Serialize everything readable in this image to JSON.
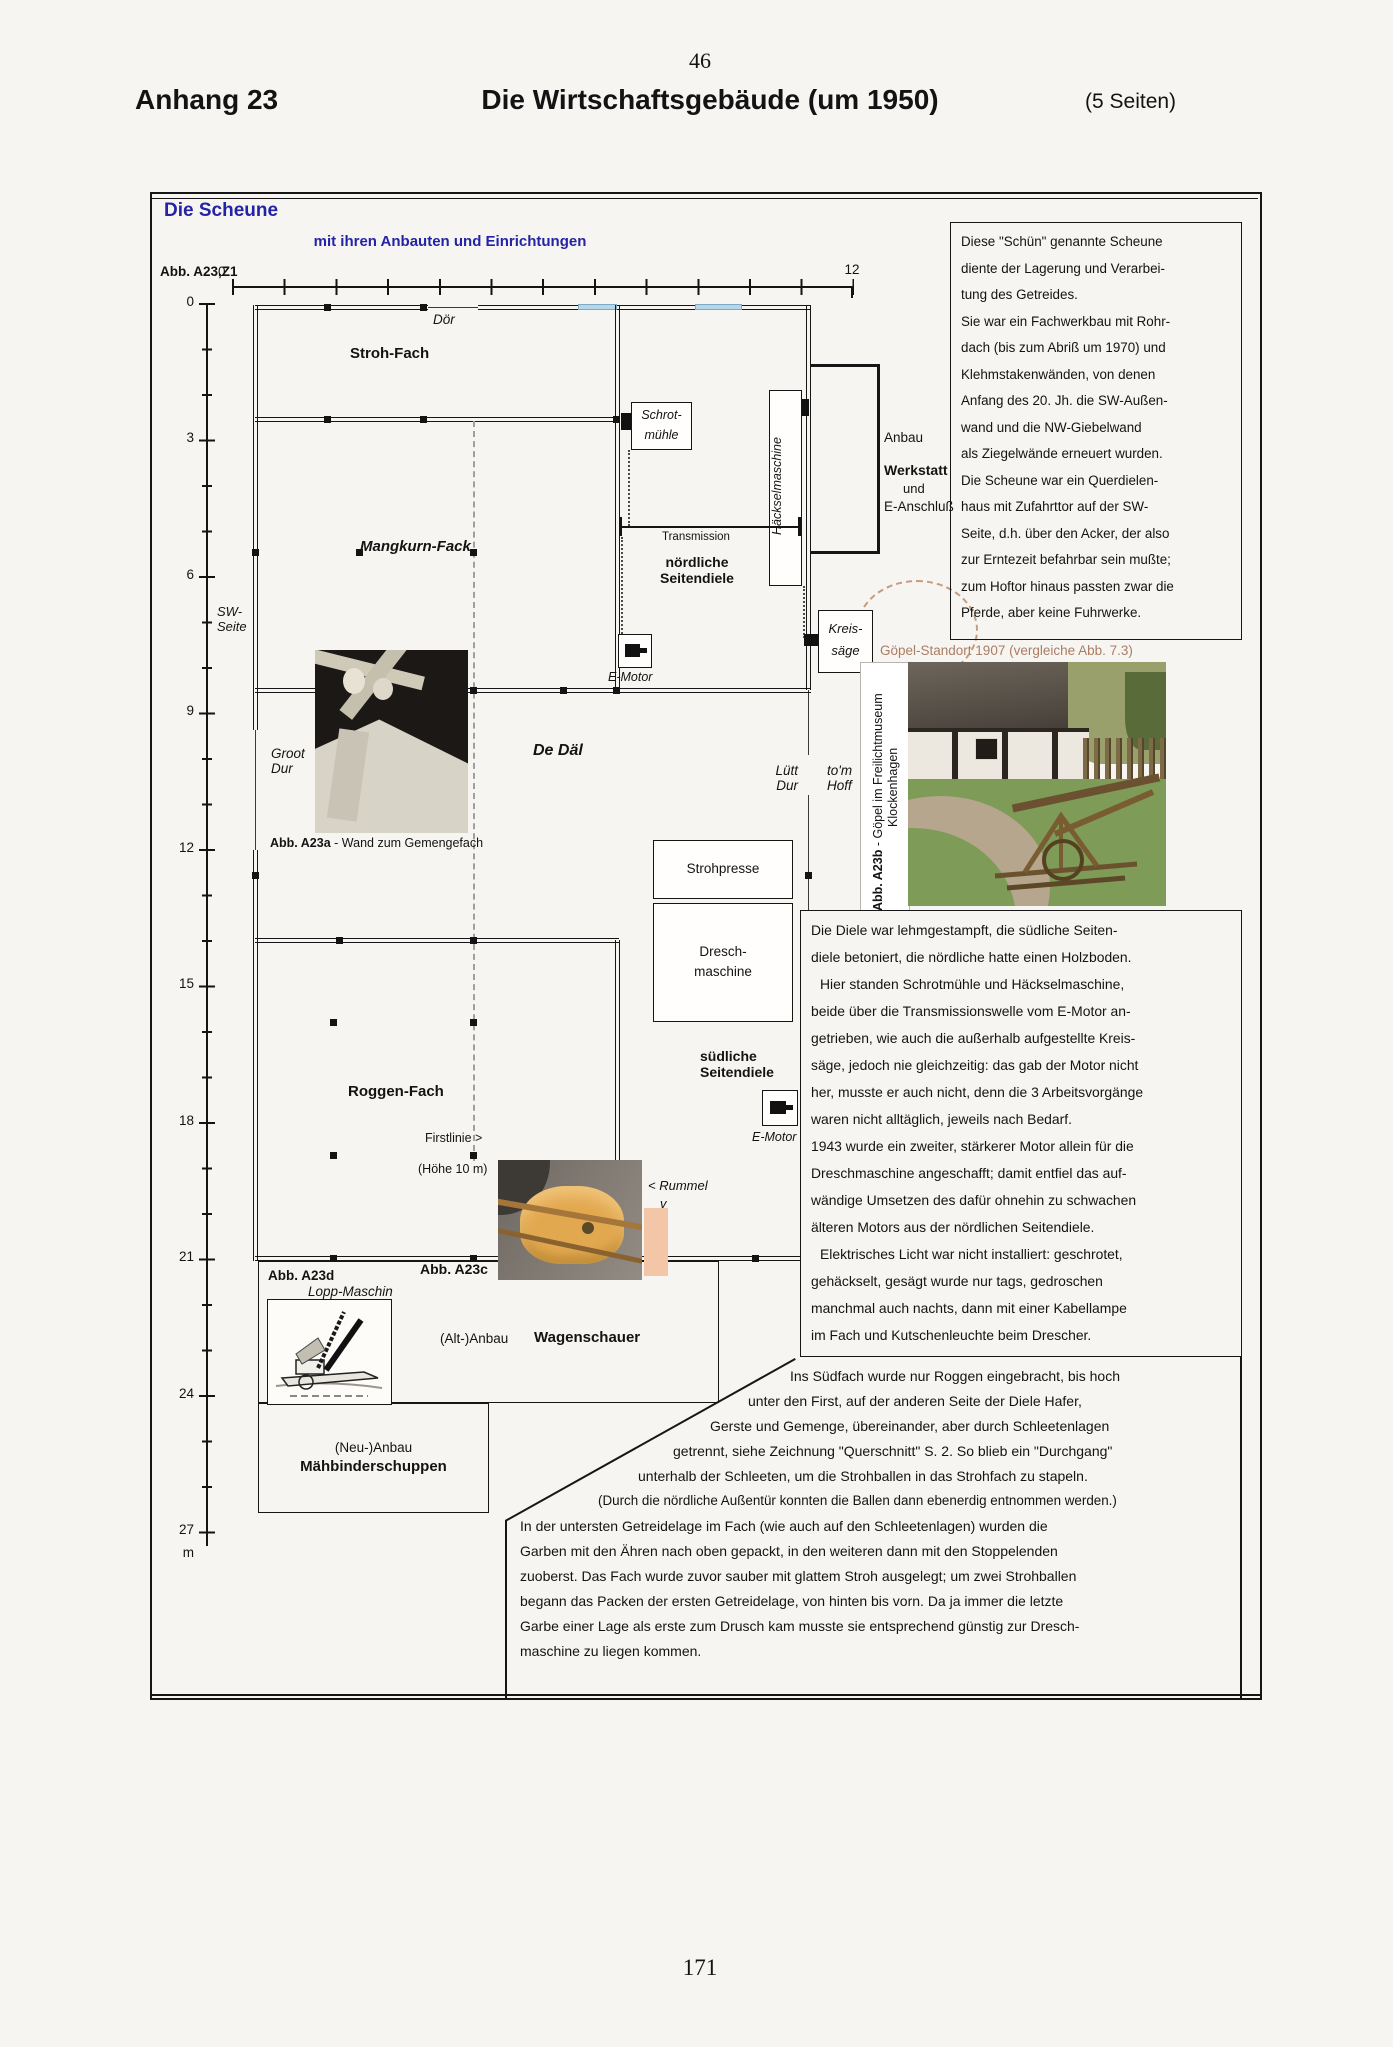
{
  "page": {
    "top_number": "46",
    "bottom_number": "171"
  },
  "header": {
    "left": "Anhang 23",
    "title": "Die Wirtschaftsgebäude (um 1950)",
    "right": "(5 Seiten)"
  },
  "box": {
    "title": "Die Scheune",
    "subtitle": "mit ihren Anbauten und Einrichtungen",
    "fig": "Abb. A23,Z1"
  },
  "ruler": {
    "h_start": "0",
    "h_end": "12",
    "v": [
      "0",
      "3",
      "6",
      "9",
      "12",
      "15",
      "18",
      "21",
      "24",
      "27"
    ],
    "unit": "m"
  },
  "plan": {
    "stroh_fach": "Stroh-Fach",
    "doer": "Dör",
    "schrot1": "Schrot-",
    "schrot2": "mühle",
    "haecksel": "Häckselmaschine",
    "anbau": "Anbau",
    "werkstatt": "Werkstatt",
    "und": "und",
    "e_anschluss": "E-Anschluß",
    "mangkurn": "Mangkurn-Fack",
    "transmission": "Transmission",
    "noerdliche1": "nördliche",
    "noerdliche2": "Seitendiele",
    "sw1": "SW-",
    "sw2": "Seite",
    "e_motor": "E-Motor",
    "kreis1": "Kreis-",
    "kreis2": "säge",
    "goepel": "Göpel-Standort 1907 (vergleiche Abb. 7.3)",
    "groot1": "Groot",
    "groot2": "Dur",
    "de_dael": "De Däl",
    "luett1": "Lütt",
    "luett2": "Dur",
    "hoff1": "to'm",
    "hoff2": "Hoff",
    "strohpresse": "Strohpresse",
    "dresch1": "Dresch-",
    "dresch2": "maschine",
    "suedliche1": "südliche",
    "suedliche2": "Seitendiele",
    "roggen": "Roggen-Fach",
    "firstlinie": "Firstlinie >",
    "hoehe": "(Höhe 10 m)",
    "rummel": "< Rummel",
    "rummel_v": "v"
  },
  "captions": {
    "a23a_b": "Abb. A23a",
    "a23a_t": " - Wand zum Gemengefach",
    "a23b_b": "Abb. A23b",
    "a23b_t": " - Göpel im Freilichtmuseum",
    "a23b_l2": "Klockenhagen",
    "a23c": "Abb. A23c",
    "a23d": "Abb. A23d",
    "a23d_t": "Lopp-Maschin",
    "alt_anbau": "(Alt-)Anbau",
    "wagenschauer": "Wagenschauer",
    "neu_anbau": "(Neu-)Anbau",
    "maehbinder": "Mähbinderschuppen"
  },
  "texts": {
    "right_top": [
      "Diese \"Schün\" genannte Scheune",
      "diente der Lagerung und Verarbei-",
      "tung des Getreides.",
      "Sie war ein Fachwerkbau mit Rohr-",
      "dach (bis zum Abriß um 1970) und",
      "Klehmstakenwänden, von denen",
      "Anfang des 20. Jh. die SW-Außen-",
      "wand und die NW-Giebelwand",
      "als Ziegelwände erneuert wurden.",
      "Die Scheune war ein Querdielen-",
      "haus mit Zufahrttor auf der SW-",
      "Seite, d.h. über den Acker, der also",
      "zur Erntezeit befahrbar sein mußte;",
      "zum Hoftor hinaus passten zwar die",
      "Pferde, aber keine Fuhrwerke."
    ],
    "right_mid": [
      "Die Diele war lehmgestampft, die südliche Seiten-",
      "diele betoniert, die nördliche hatte einen Holzboden.",
      "Hier standen Schrotmühle und Häckselmaschine,",
      "beide über die Transmissionswelle vom E-Motor an-",
      "getrieben, wie auch die außerhalb aufgestellte Kreis-",
      "säge, jedoch nie gleichzeitig: das gab der Motor nicht",
      "her, musste er auch nicht, denn die 3 Arbeitsvorgänge",
      "waren nicht alltäglich, jeweils nach Bedarf.",
      "1943 wurde ein zweiter, stärkerer Motor allein für die",
      "Dreschmaschine angeschafft; damit entfiel das auf-",
      "wändige Umsetzen des dafür ohnehin zu schwachen",
      "älteren Motors aus der nördlichen Seitendiele.",
      "Elektrisches Licht war nicht installiert: geschrotet,",
      "gehäckselt, gesägt wurde nur tags, gedroschen",
      "manchmal auch nachts, dann mit einer Kabellampe",
      "im Fach und Kutschenleuchte beim Drescher."
    ],
    "bottom": [
      "Ins Südfach wurde nur Roggen eingebracht, bis hoch",
      "unter den First, auf der anderen Seite der Diele Hafer,",
      "Gerste und Gemenge, übereinander, aber durch Schleetenlagen",
      "getrennt, siehe Zeichnung \"Querschnitt\" S. 2.  So blieb ein \"Durchgang\"",
      "unterhalb der Schleeten, um die Strohballen in das Strohfach zu stapeln.",
      "(Durch die nördliche Außentür konnten die Ballen dann ebenerdig entnommen werden.)",
      "In der untersten Getreidelage im Fach (wie auch auf den Schleetenlagen) wurden die",
      "Garben mit den Ähren nach oben gepackt, in den weiteren dann mit den Stoppelenden",
      "zuoberst. Das Fach wurde zuvor sauber mit glattem Stroh ausgelegt; um zwei Strohballen",
      "begann das Packen der ersten Getreidelage,  von hinten bis vorn. Da ja immer die letzte",
      "Garbe einer Lage als erste zum Drusch kam musste sie entsprechend günstig zur Dresch-",
      "maschine zu liegen kommen."
    ]
  },
  "colors": {
    "heading_blue": "#2323a6",
    "goepel_brown": "#aa7d64",
    "door_blue": "#b5d7e9",
    "swatch_pink": "#f2c6a6"
  }
}
